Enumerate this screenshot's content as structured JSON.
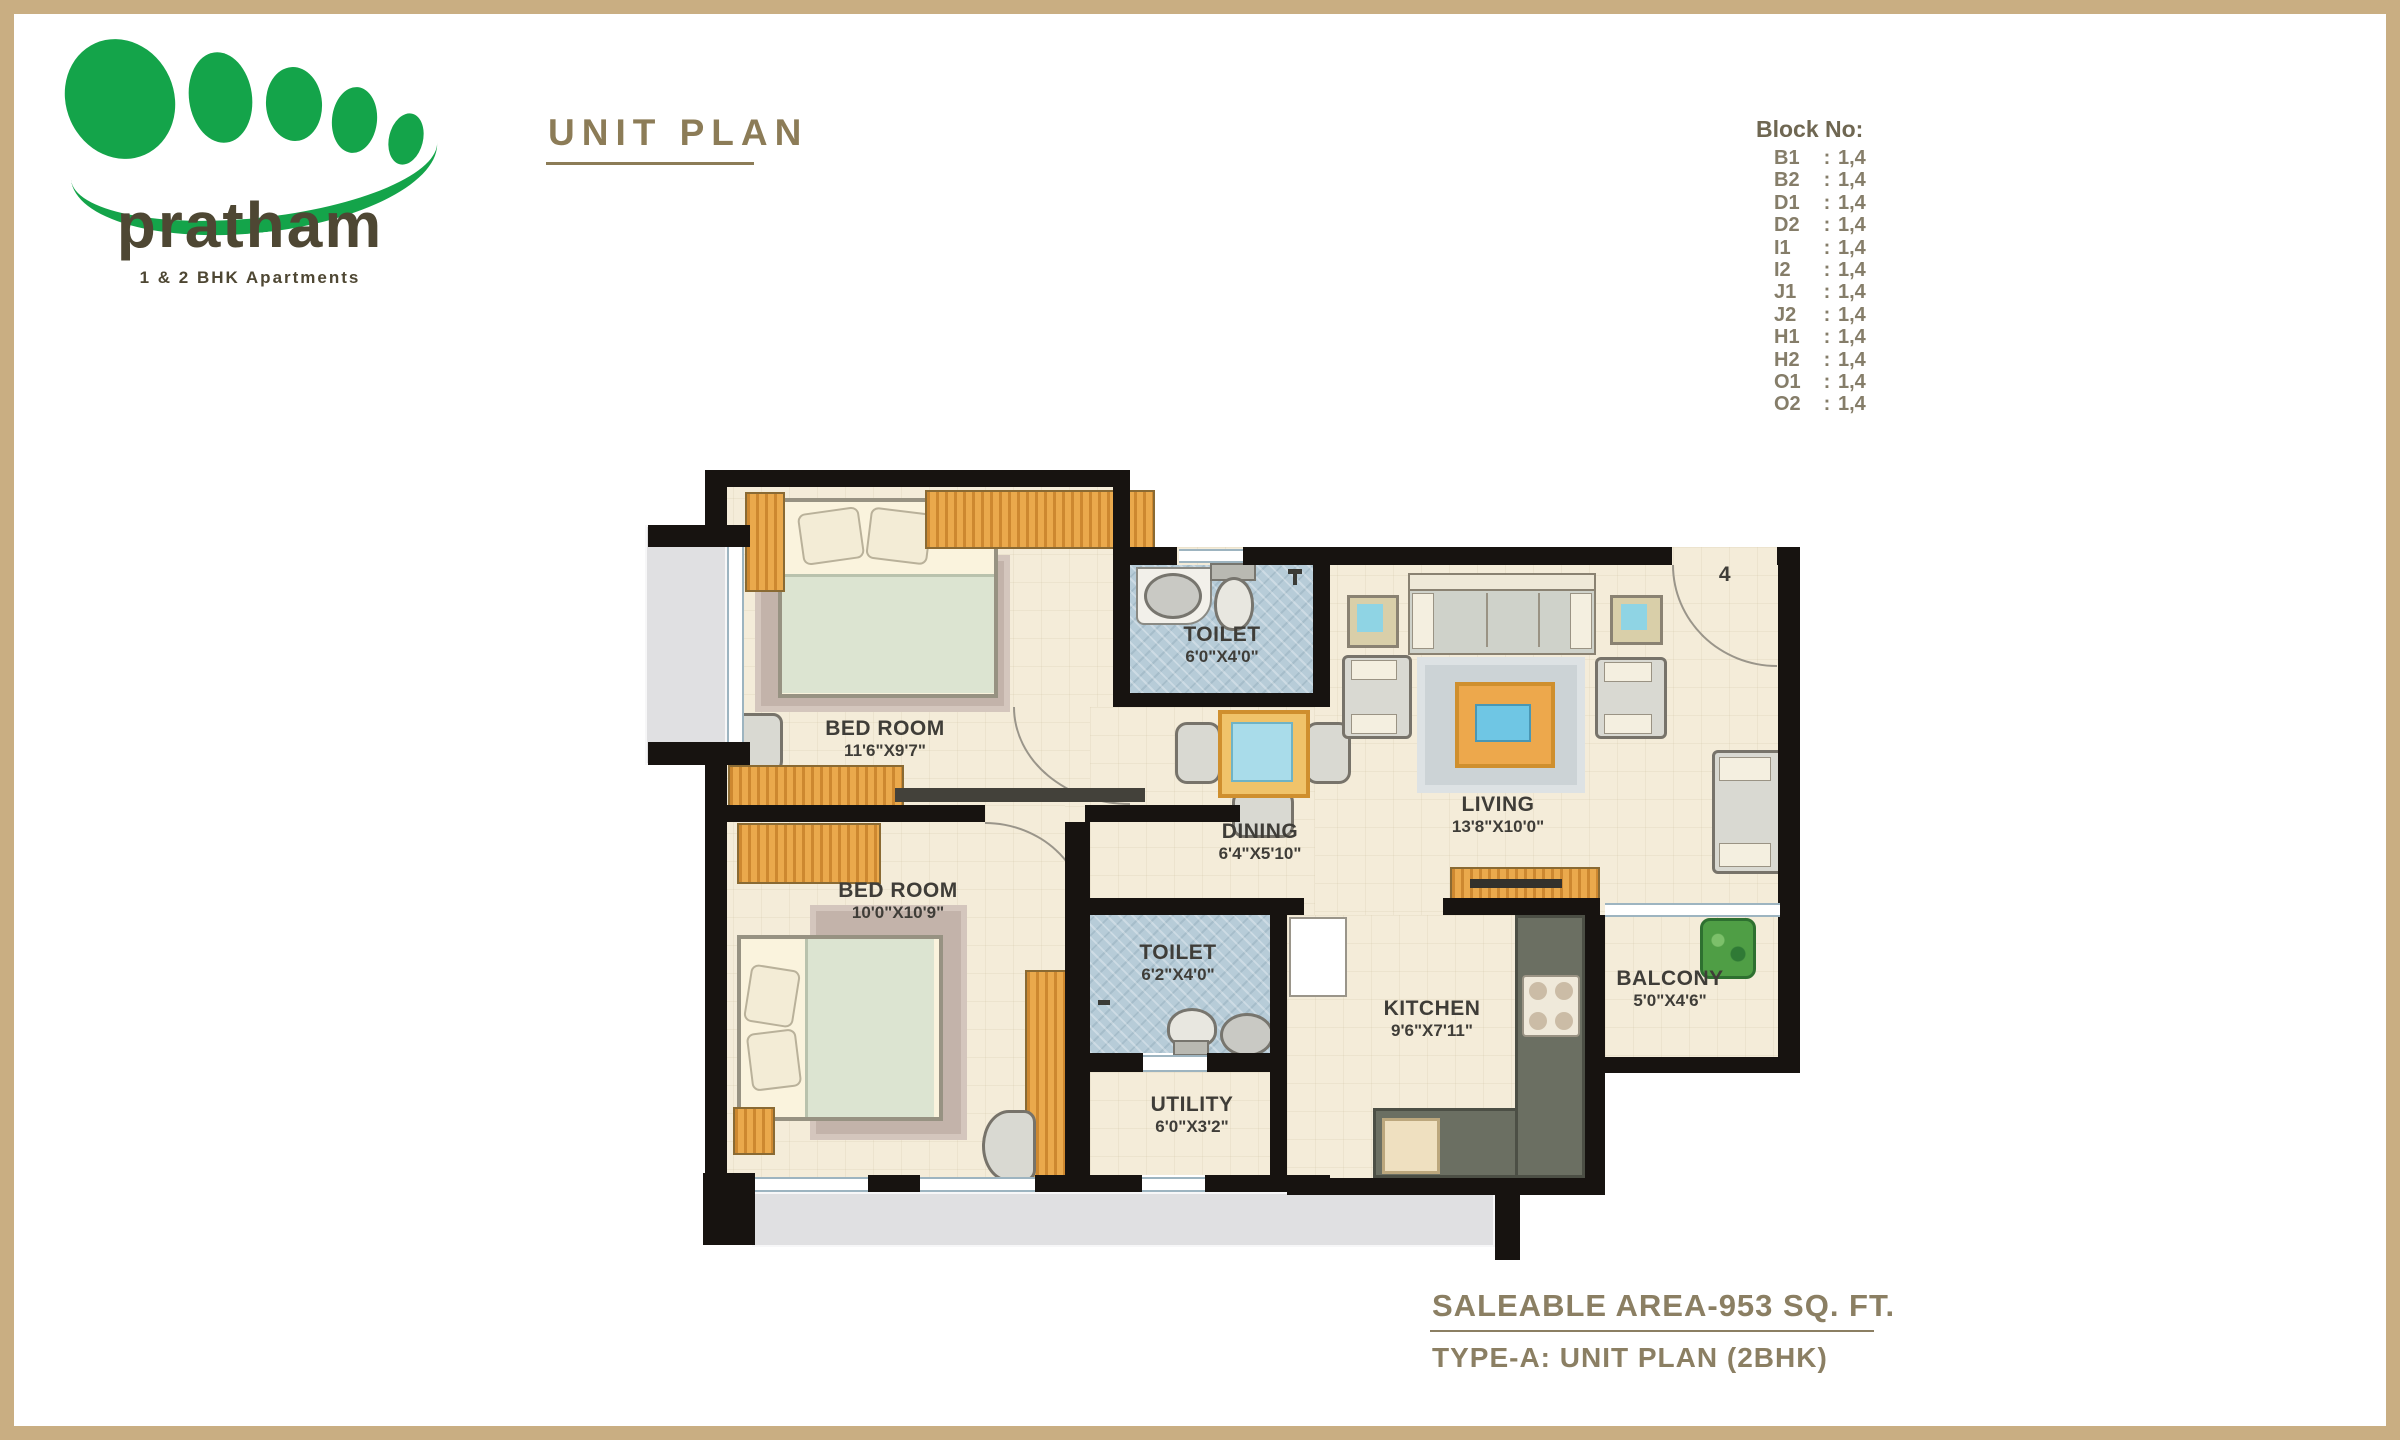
{
  "logo": {
    "name": "pratham",
    "tagline": "1 & 2 BHK Apartments"
  },
  "title": "UNIT PLAN",
  "block_no": {
    "heading": "Block No:",
    "separator": ":",
    "rows": [
      {
        "label": "B1",
        "value": "1,4"
      },
      {
        "label": "B2",
        "value": "1,4"
      },
      {
        "label": "D1",
        "value": "1,4"
      },
      {
        "label": "D2",
        "value": "1,4"
      },
      {
        "label": "I1",
        "value": "1,4"
      },
      {
        "label": "I2",
        "value": "1,4"
      },
      {
        "label": "J1",
        "value": "1,4"
      },
      {
        "label": "J2",
        "value": "1,4"
      },
      {
        "label": "H1",
        "value": "1,4"
      },
      {
        "label": "H2",
        "value": "1,4"
      },
      {
        "label": "O1",
        "value": "1,4"
      },
      {
        "label": "O2",
        "value": "1,4"
      }
    ]
  },
  "rooms": {
    "bedroom1": {
      "name": "BED ROOM",
      "dims": "11'6\"X9'7\""
    },
    "toilet1": {
      "name": "TOILET",
      "dims": "6'0\"X4'0\""
    },
    "dining": {
      "name": "DINING",
      "dims": "6'4\"X5'10\""
    },
    "living": {
      "name": "LIVING",
      "dims": "13'8\"X10'0\""
    },
    "bedroom2": {
      "name": "BED ROOM",
      "dims": "10'0\"X10'9\""
    },
    "toilet2": {
      "name": "TOILET",
      "dims": "6'2\"X4'0\""
    },
    "utility": {
      "name": "UTILITY",
      "dims": "6'0\"X3'2\""
    },
    "kitchen": {
      "name": "KITCHEN",
      "dims": "9'6\"X7'11\""
    },
    "balcony": {
      "name": "BALCONY",
      "dims": "5'0\"X4'6\""
    }
  },
  "entry_door_number": "4",
  "footer": {
    "line1": "SALEABLE AREA-953 SQ. FT.",
    "line2": "TYPE-A: UNIT PLAN (2BHK)"
  },
  "colors": {
    "frame_tan": "#c9ae82",
    "logo_green": "#14a44a",
    "heading_olive": "#8c7c57",
    "wall_black": "#171310",
    "floor_cream": "#f4ecd9",
    "wood_orange": "#e39b3d",
    "tile_blue": "#b7ccd8"
  }
}
